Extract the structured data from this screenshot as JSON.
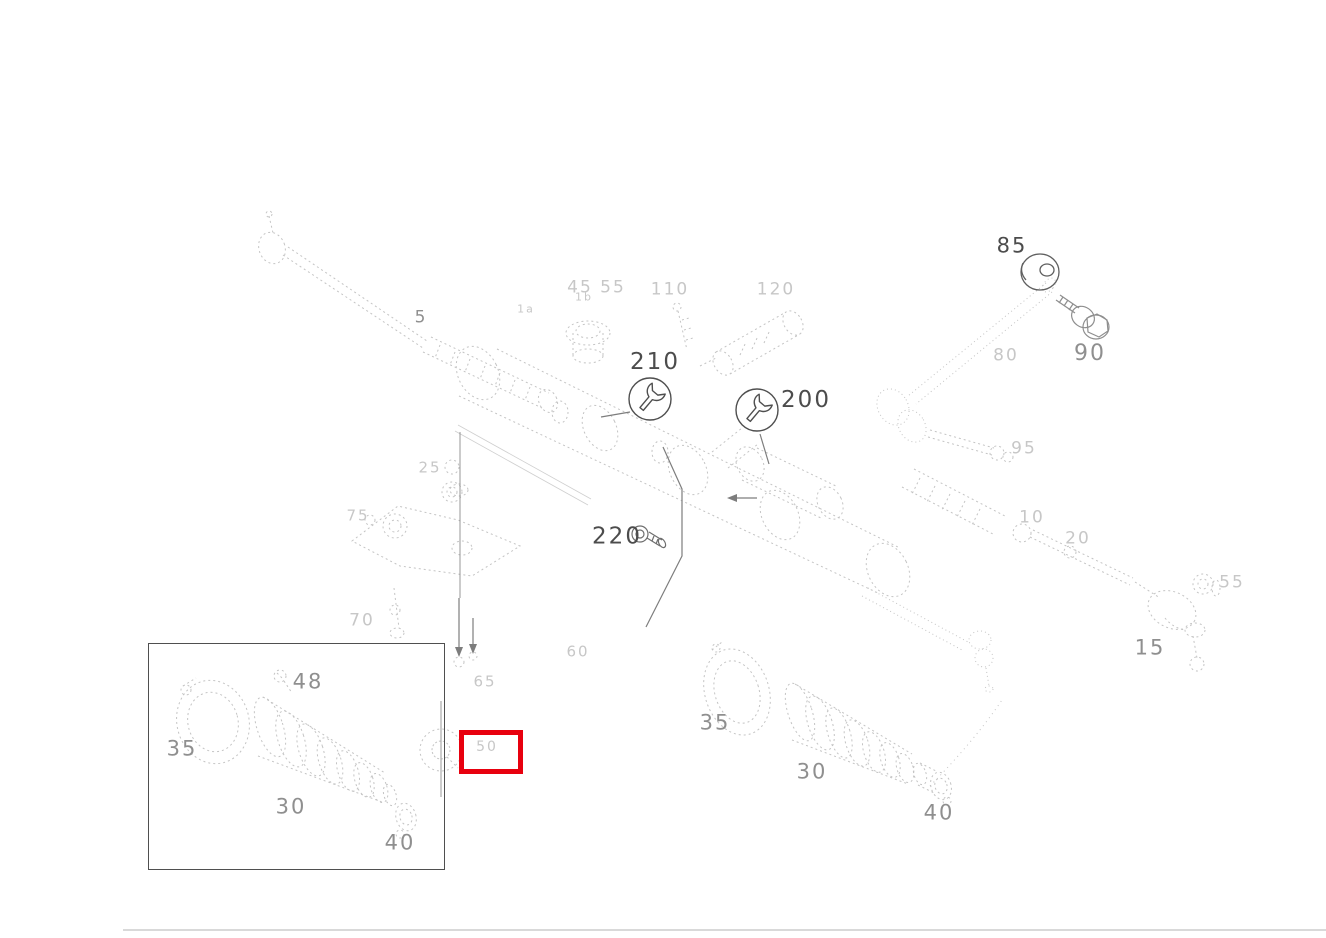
{
  "canvas": {
    "width": 1326,
    "height": 938,
    "background": "#ffffff"
  },
  "colors": {
    "highlight_red": "#e8000e",
    "label_dark": "#4c4c4c",
    "label_mid": "#8f8f8f",
    "label_faint": "#c7c7c7",
    "sketch_line": "#c4c4c4"
  },
  "wrench_callouts": [
    {
      "label": "210",
      "cx": 650,
      "cy": 399,
      "r": 22,
      "label_x": 655,
      "label_y": 362
    },
    {
      "label": "200",
      "cx": 757,
      "cy": 410,
      "r": 22,
      "label_x": 806,
      "label_y": 400
    }
  ],
  "part_labels": [
    {
      "text": "85",
      "x": 1012,
      "y": 246,
      "tone": "dark",
      "size": 21
    },
    {
      "text": "220",
      "x": 617,
      "y": 537,
      "tone": "dark",
      "size": 23
    },
    {
      "text": "90",
      "x": 1090,
      "y": 354,
      "tone": "mid",
      "size": 22
    },
    {
      "text": "5",
      "x": 421,
      "y": 318,
      "tone": "mid",
      "size": 17
    },
    {
      "text": "48",
      "x": 308,
      "y": 682,
      "tone": "mid",
      "size": 21
    },
    {
      "text": "35",
      "x": 182,
      "y": 749,
      "tone": "mid",
      "size": 21
    },
    {
      "text": "30",
      "x": 291,
      "y": 807,
      "tone": "mid",
      "size": 21
    },
    {
      "text": "40",
      "x": 400,
      "y": 843,
      "tone": "mid",
      "size": 21
    },
    {
      "text": "35",
      "x": 715,
      "y": 723,
      "tone": "mid",
      "size": 21
    },
    {
      "text": "30",
      "x": 812,
      "y": 772,
      "tone": "mid",
      "size": 21
    },
    {
      "text": "40",
      "x": 939,
      "y": 813,
      "tone": "mid",
      "size": 21
    },
    {
      "text": "15",
      "x": 1150,
      "y": 648,
      "tone": "mid",
      "size": 21
    },
    {
      "text": "45",
      "x": 580,
      "y": 288,
      "tone": "faint",
      "size": 17
    },
    {
      "text": "55",
      "x": 613,
      "y": 288,
      "tone": "faint",
      "size": 17
    },
    {
      "text": "110",
      "x": 670,
      "y": 290,
      "tone": "faint",
      "size": 17
    },
    {
      "text": "120",
      "x": 776,
      "y": 290,
      "tone": "faint",
      "size": 17
    },
    {
      "text": "80",
      "x": 1006,
      "y": 356,
      "tone": "faint",
      "size": 17
    },
    {
      "text": "95",
      "x": 1024,
      "y": 449,
      "tone": "faint",
      "size": 17
    },
    {
      "text": "10",
      "x": 1032,
      "y": 518,
      "tone": "faint",
      "size": 17
    },
    {
      "text": "20",
      "x": 1078,
      "y": 539,
      "tone": "faint",
      "size": 17
    },
    {
      "text": "55",
      "x": 1232,
      "y": 583,
      "tone": "faint",
      "size": 17
    },
    {
      "text": "25",
      "x": 430,
      "y": 468,
      "tone": "faint",
      "size": 15
    },
    {
      "text": "75",
      "x": 358,
      "y": 516,
      "tone": "faint",
      "size": 15
    },
    {
      "text": "70",
      "x": 362,
      "y": 621,
      "tone": "faint",
      "size": 17
    },
    {
      "text": "65",
      "x": 485,
      "y": 682,
      "tone": "faint",
      "size": 15
    },
    {
      "text": "60",
      "x": 578,
      "y": 652,
      "tone": "faint",
      "size": 15
    },
    {
      "text": "50",
      "x": 487,
      "y": 747,
      "tone": "faint",
      "size": 14
    },
    {
      "text": "1a",
      "x": 526,
      "y": 309,
      "tone": "faint",
      "size": 11
    },
    {
      "text": "1b",
      "x": 584,
      "y": 297,
      "tone": "faint",
      "size": 11
    }
  ],
  "inset_box": {
    "x": 148,
    "y": 643,
    "width": 295,
    "height": 225
  },
  "highlight_box": {
    "x": 459,
    "y": 730,
    "width": 54,
    "height": 34,
    "thickness": 5
  },
  "footer_line": {
    "x": 123,
    "y": 929,
    "width": 1203
  }
}
